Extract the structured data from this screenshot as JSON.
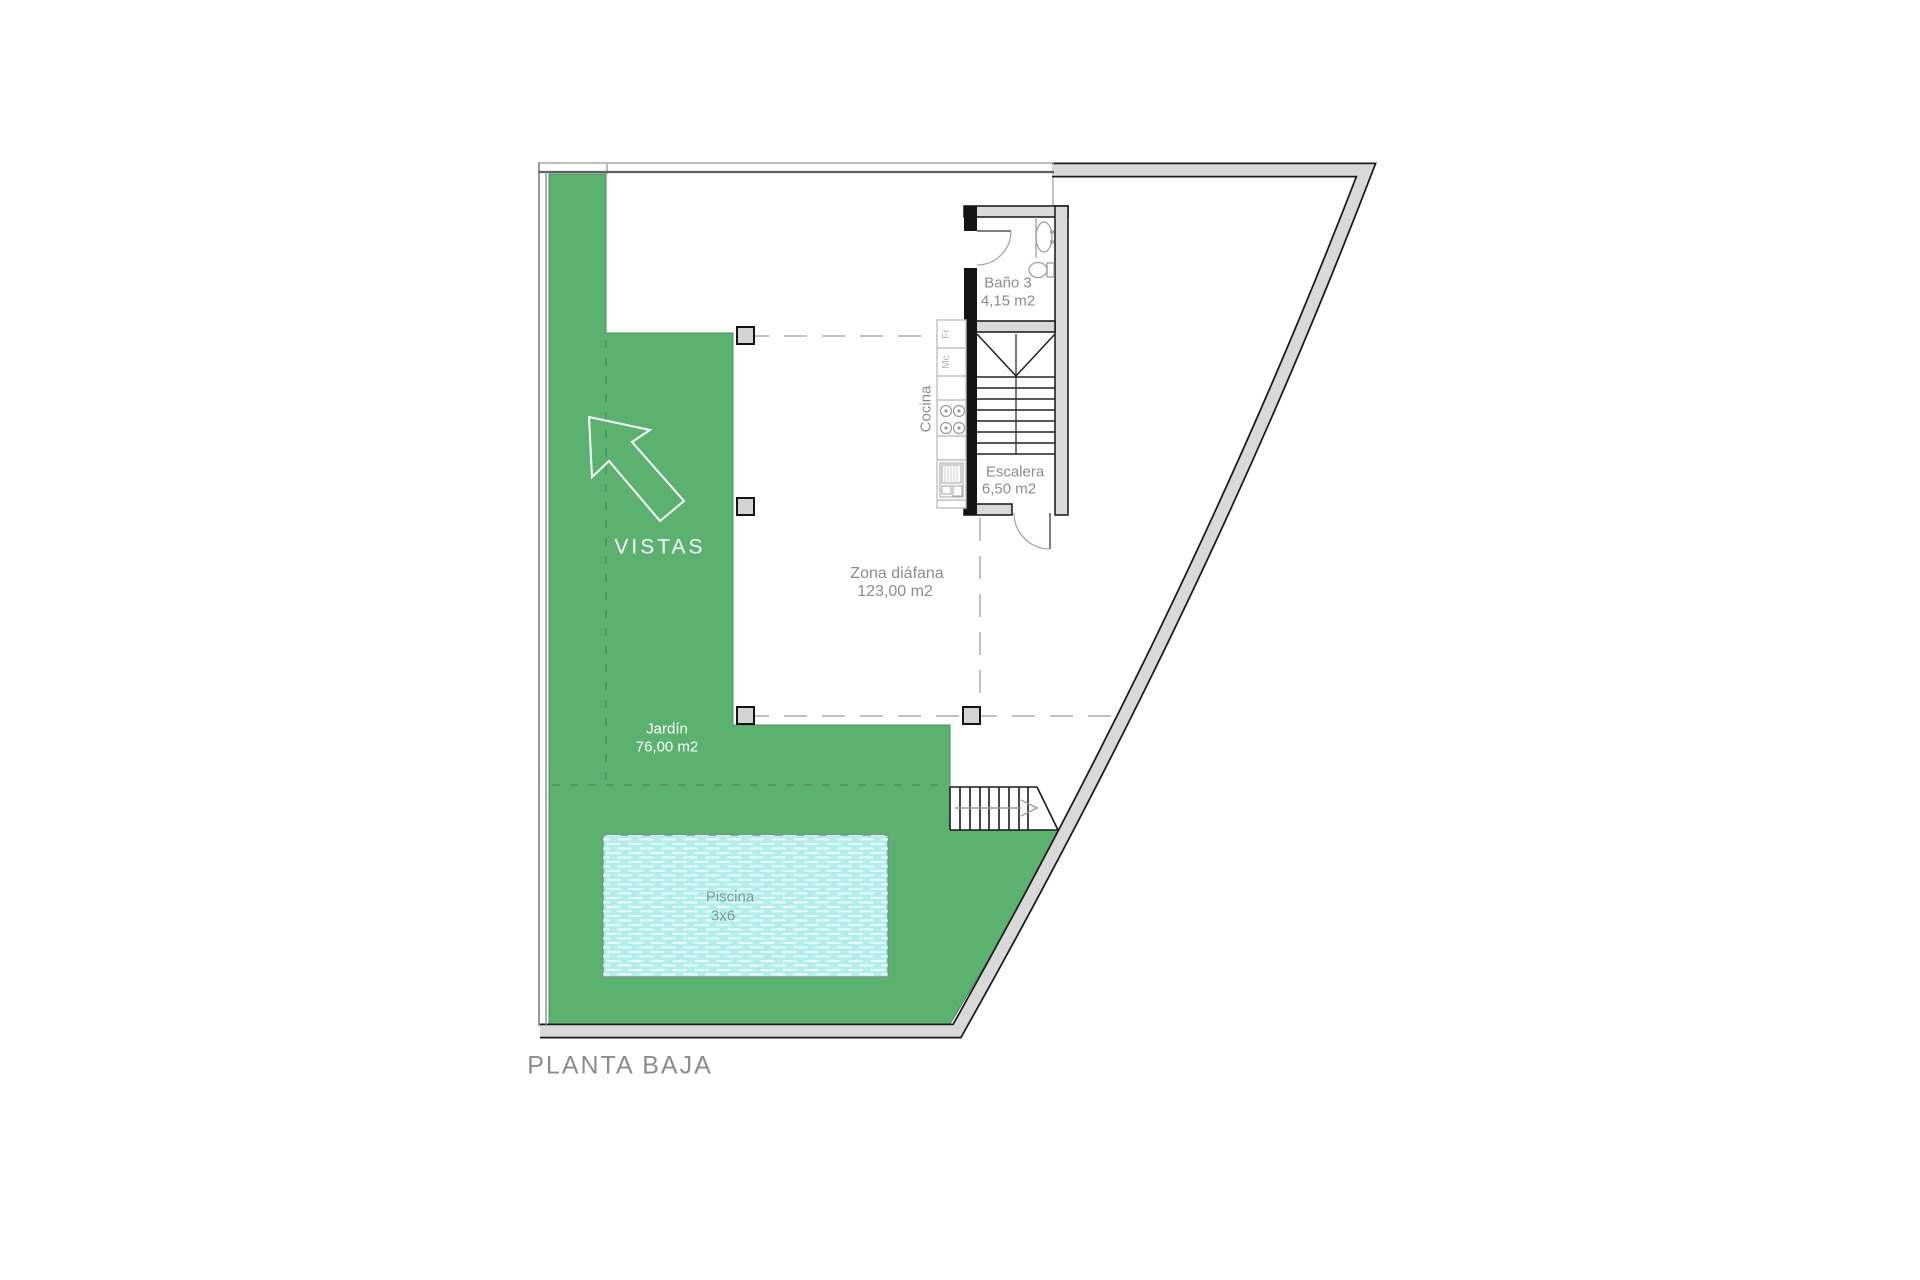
{
  "title": {
    "label": "PLANTA BAJA"
  },
  "colors": {
    "garden_green": "#5BB26E",
    "pool_water": "#AFF0EC",
    "wall_gray": "#D9D9D9",
    "label_gray": "#8C8C8C"
  },
  "garden": {
    "name": "Jardín",
    "area": "76,00 m2",
    "views": "VISTAS"
  },
  "pool": {
    "name": "Piscina",
    "dimensions": "3x6"
  },
  "open_zone": {
    "name": "Zona diáfana",
    "area": "123,00 m2"
  },
  "kitchen": {
    "name": "Cocina",
    "fridge": "Fr",
    "microwave": "Mc"
  },
  "bathroom": {
    "name": "Baño 3",
    "area": "4,15 m2"
  },
  "stairs": {
    "name": "Escalera",
    "area": "6,50 m2"
  }
}
